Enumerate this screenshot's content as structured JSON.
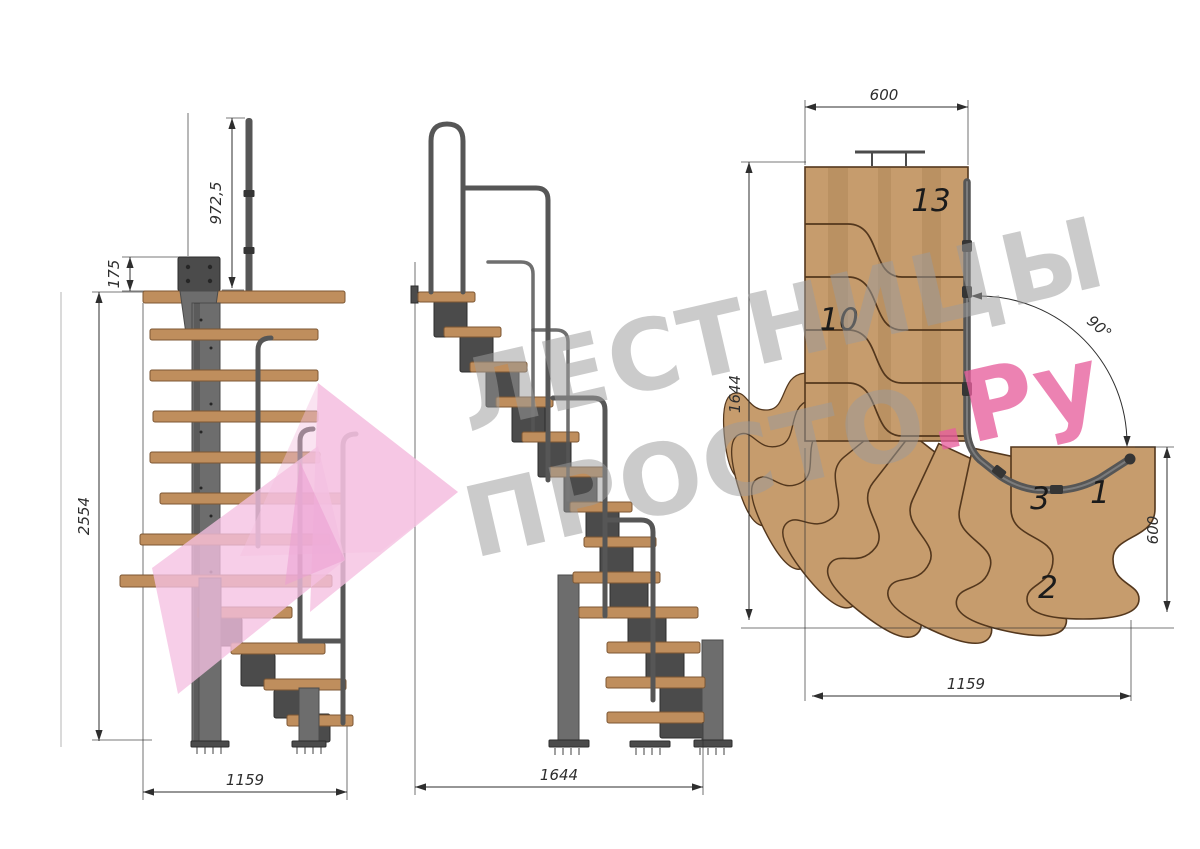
{
  "colors": {
    "bg": "#ffffff",
    "wood": "#bf8e5d",
    "wood_edge": "#7c5733",
    "plan_wood": "#c69c6d",
    "plan_wood_dark": "#a37a4b",
    "plan_edge": "#53371d",
    "metal": "#6d6d6d",
    "metal_dark": "#4b4b4b",
    "rail": "#565656",
    "rail_dark": "#353535",
    "dim": "#2e2e2e",
    "step_ink": "#1b1b1b",
    "wm_grey": "#9b9b9b",
    "wm_pink": "#e75f9c",
    "wm_arrow": "#f5c0e1",
    "wm_arrow_dark": "#eb9fd1"
  },
  "front_view": {
    "dim_rail_height": "972,5",
    "dim_plate_height": "175",
    "dim_total_height": "2554",
    "dim_width": "1159"
  },
  "side_view": {
    "dim_length": "1644"
  },
  "plan_view": {
    "dim_top_width": "600",
    "dim_left_depth": "1644",
    "dim_angle": "90°",
    "dim_right_height": "600",
    "dim_bottom_width": "1159",
    "steps": {
      "n13": "13",
      "n10": "10",
      "n3": "3",
      "n1": "1",
      "n2": "2"
    }
  },
  "watermark": {
    "line1": "ЛЕСТНИЦЫ",
    "line2_grey": "ПРОСТО",
    "line2_pink": ".Ру"
  }
}
